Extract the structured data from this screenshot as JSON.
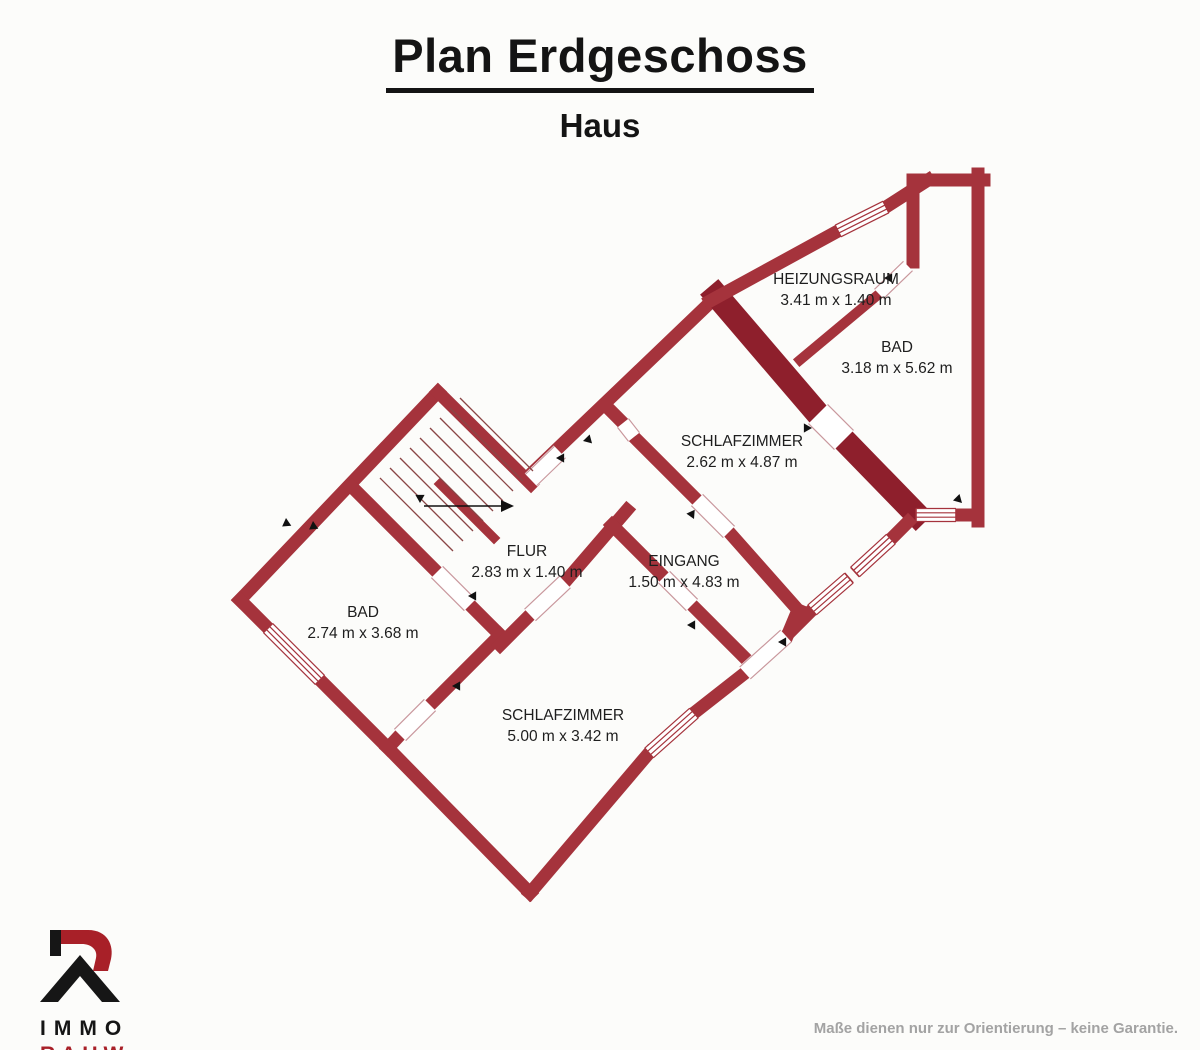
{
  "header": {
    "title": "Plan Erdgeschoss",
    "subtitle": "Haus"
  },
  "footer": {
    "brand_line1": "IMMO",
    "brand_line2": "RAUW",
    "disclaimer": "Maße dienen nur zur Orientierung – keine Garantie."
  },
  "colors": {
    "wall": "#a5333c",
    "wall_dark": "#8e1f2c",
    "window_line": "#a5333c",
    "door_edge": "#c9989d",
    "tread": "#8a4545",
    "marker": "#111111",
    "label": "#1e1e1e",
    "brand_red": "#a82028"
  },
  "plan": {
    "rooms": [
      {
        "name": "HEIZUNGSRAUM",
        "dims": "3.41 m x 1.40 m",
        "x": 836,
        "y": 284
      },
      {
        "name": "BAD",
        "dims": "3.18 m x 5.62 m",
        "x": 897,
        "y": 352
      },
      {
        "name": "SCHLAFZIMMER",
        "dims": "2.62 m x 4.87 m",
        "x": 742,
        "y": 446
      },
      {
        "name": "FLUR",
        "dims": "2.83 m x 1.40 m",
        "x": 527,
        "y": 556
      },
      {
        "name": "EINGANG",
        "dims": "1.50 m x 4.83 m",
        "x": 684,
        "y": 566
      },
      {
        "name": "BAD",
        "dims": "2.74 m x 3.68 m",
        "x": 363,
        "y": 617
      },
      {
        "name": "SCHLAFZIMMER",
        "dims": "5.00 m x 3.42 m",
        "x": 563,
        "y": 720
      }
    ],
    "walls": [
      [
        240,
        600,
        438,
        392,
        13,
        "n"
      ],
      [
        438,
        392,
        531,
        484,
        13,
        "n"
      ],
      [
        531,
        474,
        717,
        296,
        13,
        "n"
      ],
      [
        605,
        405,
        623,
        423,
        13,
        "n"
      ],
      [
        634,
        437,
        697,
        500,
        13,
        "n"
      ],
      [
        729,
        532,
        798,
        610,
        13,
        "n"
      ],
      [
        798,
        610,
        788,
        634,
        13,
        "n"
      ],
      [
        717,
        296,
        818,
        414,
        24,
        "d"
      ],
      [
        844,
        440,
        916,
        514,
        24,
        "d"
      ],
      [
        710,
        301,
        838,
        231,
        13,
        "n"
      ],
      [
        886,
        207,
        928,
        180,
        13,
        "n"
      ],
      [
        916,
        180,
        984,
        180,
        13,
        "n"
      ],
      [
        978,
        174,
        978,
        521,
        13,
        "n"
      ],
      [
        978,
        515,
        956,
        515,
        13,
        "n"
      ],
      [
        800,
        360,
        879,
        294,
        10,
        "n"
      ],
      [
        913,
        180,
        913,
        262,
        13,
        "n"
      ],
      [
        352,
        487,
        437,
        572,
        13,
        "n"
      ],
      [
        470,
        605,
        500,
        635,
        13,
        "n"
      ],
      [
        500,
        635,
        430,
        705,
        13,
        "n"
      ],
      [
        400,
        735,
        388,
        748,
        13,
        "n"
      ],
      [
        530,
        893,
        388,
        748,
        13,
        "n"
      ],
      [
        388,
        748,
        320,
        680,
        13,
        "n"
      ],
      [
        268,
        628,
        240,
        600,
        13,
        "n"
      ],
      [
        908,
        522,
        891,
        539,
        13,
        "n"
      ],
      [
        812,
        610,
        786,
        636,
        13,
        "n"
      ],
      [
        745,
        673,
        694,
        713,
        13,
        "n"
      ],
      [
        649,
        753,
        530,
        893,
        13,
        "n"
      ],
      [
        627,
        510,
        565,
        582,
        13,
        "n"
      ],
      [
        530,
        615,
        500,
        645,
        13,
        "n"
      ],
      [
        612,
        525,
        664,
        577,
        13,
        "n"
      ],
      [
        692,
        605,
        750,
        663,
        13,
        "n"
      ],
      [
        440,
        484,
        494,
        538,
        9,
        "n"
      ]
    ],
    "windows": [
      [
        838,
        231,
        886,
        207
      ],
      [
        956,
        515,
        916,
        515
      ],
      [
        891,
        539,
        855,
        572
      ],
      [
        849,
        578,
        812,
        610
      ],
      [
        694,
        713,
        649,
        753
      ],
      [
        320,
        680,
        268,
        628
      ]
    ],
    "doors": [
      [
        531,
        480,
        560,
        452,
        16
      ],
      [
        818,
        414,
        844,
        440,
        27
      ],
      [
        879,
        294,
        908,
        266,
        13
      ],
      [
        786,
        636,
        745,
        673,
        16
      ],
      [
        437,
        572,
        470,
        605,
        16
      ],
      [
        430,
        705,
        400,
        735,
        16
      ],
      [
        565,
        582,
        530,
        615,
        16
      ],
      [
        664,
        577,
        692,
        605,
        16
      ],
      [
        697,
        500,
        729,
        532,
        16
      ],
      [
        623,
        423,
        634,
        437,
        14
      ]
    ],
    "treads": [
      [
        380,
        478,
        453,
        551
      ],
      [
        390,
        468,
        463,
        541
      ],
      [
        400,
        458,
        473,
        531
      ],
      [
        410,
        448,
        483,
        521
      ],
      [
        420,
        438,
        493,
        511
      ],
      [
        430,
        428,
        503,
        501
      ],
      [
        440,
        418,
        513,
        491
      ],
      [
        450,
        408,
        523,
        481
      ],
      [
        460,
        398,
        533,
        471
      ]
    ],
    "stairs_arrow": {
      "x1": 424,
      "y1": 506,
      "x2": 501,
      "y2": 506
    },
    "markers": [
      [
        286,
        518,
        40
      ],
      [
        313,
        521,
        40
      ],
      [
        583,
        441,
        -60
      ],
      [
        694,
        519,
        200
      ],
      [
        687,
        625,
        -45
      ],
      [
        468,
        596,
        -45
      ],
      [
        452,
        686,
        -45
      ],
      [
        812,
        428,
        135
      ],
      [
        884,
        278,
        -45
      ],
      [
        962,
        503,
        180
      ],
      [
        778,
        642,
        -45
      ],
      [
        556,
        458,
        -45
      ],
      [
        420,
        503,
        225
      ]
    ]
  }
}
